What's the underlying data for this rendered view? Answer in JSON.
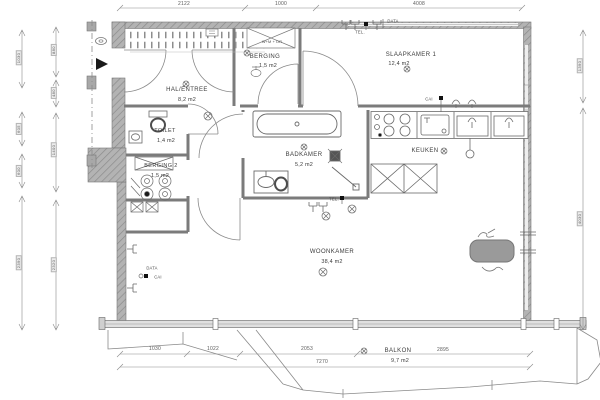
{
  "drawing": {
    "title": "apartment floor plan",
    "rooms": [
      {
        "name": "HAL/ENTREE",
        "area": "8,2 m2"
      },
      {
        "name": "BERGING",
        "area": "1,5 m2"
      },
      {
        "name": "SLAAPKAMER 1",
        "area": "12,4 m2"
      },
      {
        "name": "TOILET",
        "area": "1,4 m2"
      },
      {
        "name": "BERGING 2",
        "area": "1,5 m2"
      },
      {
        "name": "BADKAMER",
        "area": "5,2 m2"
      },
      {
        "name": "KEUKEN",
        "area": ""
      },
      {
        "name": "WOONKAMER",
        "area": "38,4 m2"
      },
      {
        "name": "BALKON",
        "area": "9,7 m2"
      }
    ],
    "tags": {
      "tel": "TEL.",
      "data": "DATA",
      "cai": "CAI",
      "washer_dryer": "W+M + DR"
    },
    "dimensions": {
      "top": [
        "2122",
        "1000",
        "4008"
      ],
      "bottom": [
        "1030",
        "1022",
        "2053",
        "2895"
      ],
      "bottom_total": "7270",
      "left_outer": [
        "1030",
        "605",
        "600",
        "2390"
      ],
      "left_inner": [
        "880",
        "480",
        "1400",
        "2320"
      ],
      "right": [
        "1390",
        "4030"
      ]
    },
    "colors": {
      "wall_fill": "#b3b3b3",
      "wall_hatch": "#8c8c8c",
      "line": "#6e6e6e",
      "fixture": "#6a6a6a",
      "text": "#3c3c3c",
      "facade": "#e0e0e0",
      "blob": "#9a9a9a"
    }
  }
}
